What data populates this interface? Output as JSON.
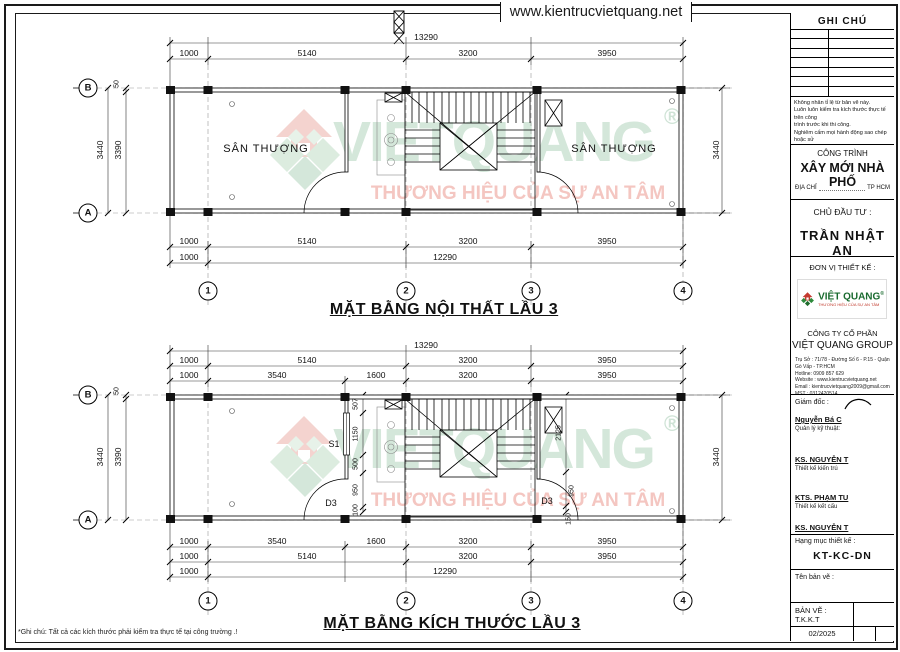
{
  "header": {
    "url": "www.kientrucvietquang.net"
  },
  "watermark": {
    "wordmark": "VIETQUANG",
    "registered": "®",
    "tagline": "THƯƠNG HIỆU CỦA SỰ AN TÂM"
  },
  "plan1": {
    "title": "MẶT BẰNG NỘI THẤT LẦU 3",
    "room_left": "SÂN THƯỢNG",
    "room_right": "SÂN THƯỢNG",
    "grid": {
      "b": "B",
      "a": "A",
      "n1": "1",
      "n2": "2",
      "n3": "3",
      "n4": "4"
    },
    "dims": {
      "total_top": "13290",
      "top": [
        "1000",
        "5140",
        "3200",
        "3950"
      ],
      "bottom": [
        "1000",
        "5140",
        "3200",
        "3950"
      ],
      "bottom2_left": "1000",
      "bottom_total": "12290",
      "left_outer": "3440",
      "left_inner": "3390",
      "left_small": "50",
      "right": "3440"
    }
  },
  "plan2": {
    "title": "MẶT BẰNG KÍCH THƯỚC LẦU 3",
    "labels": {
      "s1": "S1",
      "d3_left": "D3",
      "d3_right": "D3"
    },
    "grid": {
      "b": "B",
      "a": "A",
      "n1": "1",
      "n2": "2",
      "n3": "3",
      "n4": "4"
    },
    "dims": {
      "total_top": "13290",
      "top1": [
        "1000",
        "5140",
        "3200",
        "3950"
      ],
      "top2": [
        "1000",
        "3540",
        "1600",
        "3200",
        "3950"
      ],
      "bottom1": [
        "1000",
        "3540",
        "1600",
        "3200",
        "3950"
      ],
      "bottom2": [
        "1000",
        "5140",
        "3200",
        "3950"
      ],
      "bottom3_left": "1000",
      "bottom_total": "12290",
      "left_outer": "3440",
      "left_inner": "3390",
      "left_small": "50",
      "right": "3440",
      "chain_left": [
        "507",
        "1150",
        "500",
        "950",
        "100"
      ],
      "chain_right": [
        "2125",
        "950",
        "150"
      ]
    }
  },
  "titleblock": {
    "ghi_chu": "GHI CHÚ",
    "notes": [
      "Không nhân tỉ lệ từ bản vẽ này.",
      "Luôn luôn kiểm tra kích thước thực tế trên công",
      "trình trước khi thi công.",
      "Nghiêm cấm mọi hành động sao chép hoặc sử",
      "dụng lại thông tin từ bản vẽ này mà không được",
      "sự cho phép của Công ty TNHH Xây Dựng Việt Quang Group"
    ],
    "cong_trinh_label": "CÔNG TRÌNH",
    "cong_trinh_value": "XÂY MỚI NHÀ PHỐ",
    "dia_chi_label": "ĐỊA CHỈ",
    "dia_chi_value": "TP HCM",
    "chu_dau_tu_label": "CHỦ ĐẦU TƯ :",
    "chu_dau_tu_value": "TRẦN NHẬT AN",
    "don_vi_label": "ĐƠN VỊ THIẾT KẾ :",
    "logo_text": "VIỆT QUANG",
    "logo_reg": "®",
    "logo_tagline": "THƯƠNG HIỆU CỦA SỰ AN TÂM",
    "company_line1": "CÔNG TY CỔ PHẦN",
    "company_line2": "VIỆT QUANG GROUP",
    "address": [
      "Trụ Sở : 71/78 - Đường Số 6 - P.15 - Quận Gò Vấp - TP.HCM",
      "Hotline: 0909 857 629",
      "Website : www.kientrucvietquang.net",
      "Email : kientrucvietquang2009@gmail.com",
      "MST : 0312420514"
    ],
    "giam_doc_label": "Giám đốc :",
    "director_name": "Nguyễn Bá C",
    "director_role": "Quản lý kỹ thuật:",
    "signer1_name": "KS. NGUYỄN T",
    "signer1_role": "Thiết kế kiến trú",
    "signer2_name": "KTS. PHẠM TU",
    "signer2_role": "Thiết kế kết cấu",
    "signer3_name": "KS. NGUYỄN T",
    "hang_muc_label": "Hạng mục thiết kế :",
    "hang_muc_value": "KT-KC-DN",
    "ten_ban_ve_label": "Tên bản vẽ :",
    "ban_ve": "BẢN VẼ : T.K.K.T",
    "date": "02/2025"
  },
  "footnote": "*Ghi chú: Tất cả các kích thước phải kiểm tra thực tế tại công trường .!"
}
